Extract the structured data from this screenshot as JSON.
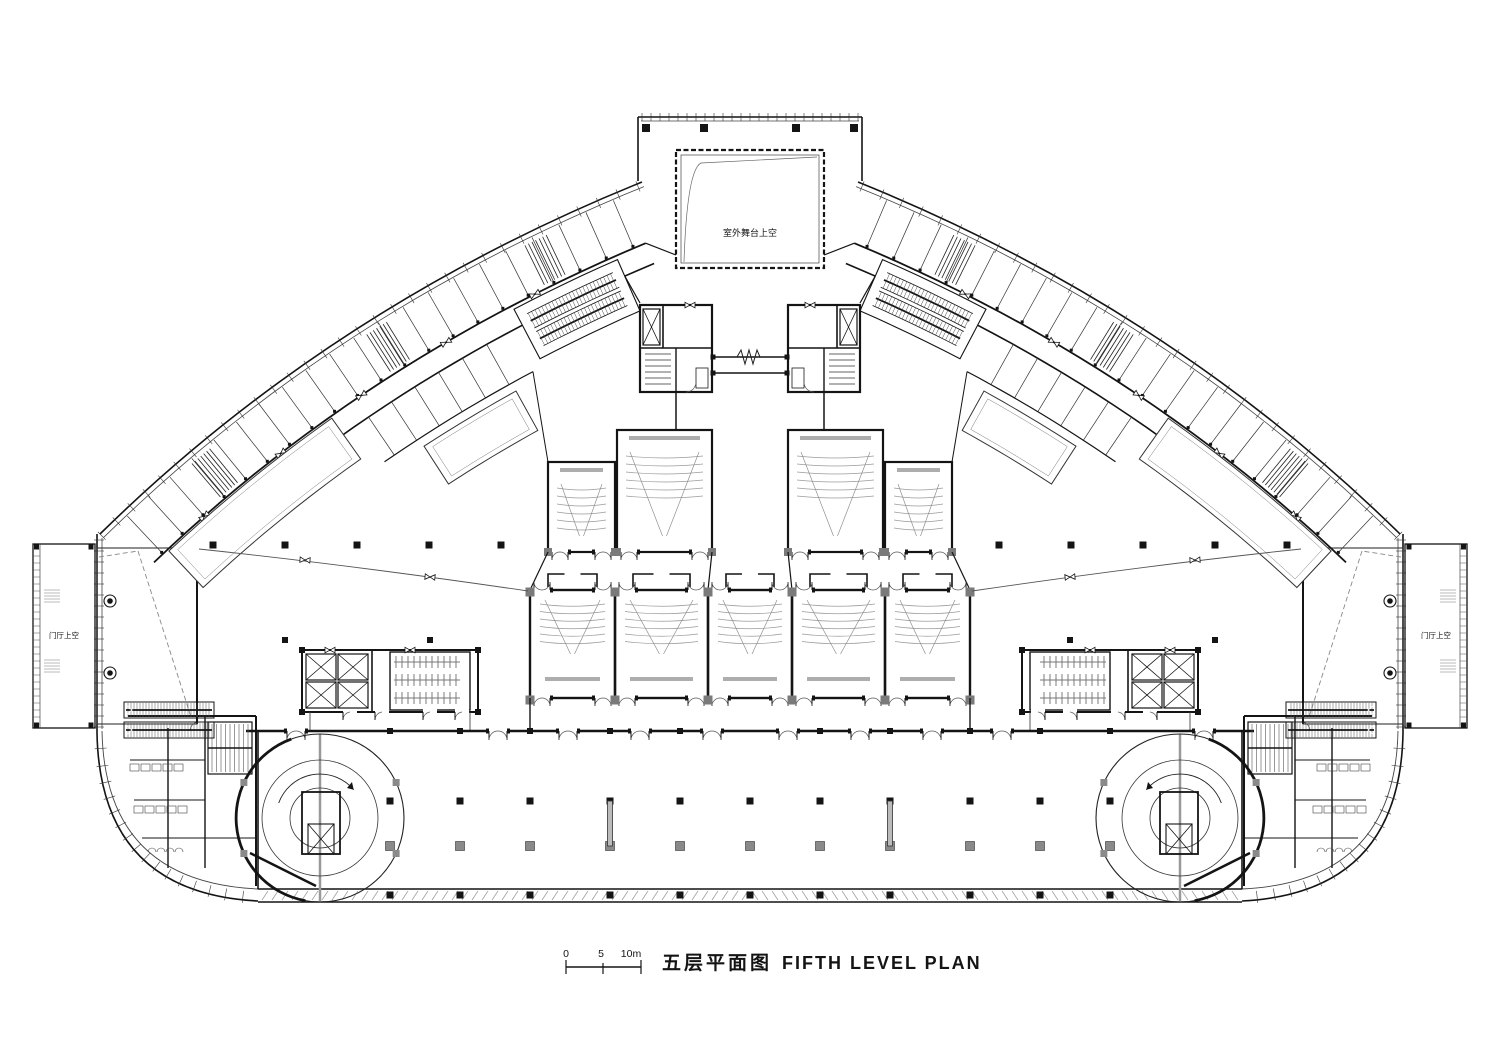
{
  "title": {
    "cn": "五层平面图",
    "en": "FIFTH LEVEL PLAN"
  },
  "scale_bar": {
    "t0": "0",
    "t1": "5",
    "t2": "10m"
  },
  "labels": {
    "stage_void": "室外舞台上空",
    "lobby_void_left": "门厅上空",
    "lobby_void_right": "门厅上空"
  },
  "colors": {
    "ink": "#141414",
    "wall": "#1c1c1c",
    "mid_gray": "#777777",
    "light_gray": "#aaaaaa",
    "seat_gray": "#9a9a9a",
    "paper": "#ffffff"
  }
}
